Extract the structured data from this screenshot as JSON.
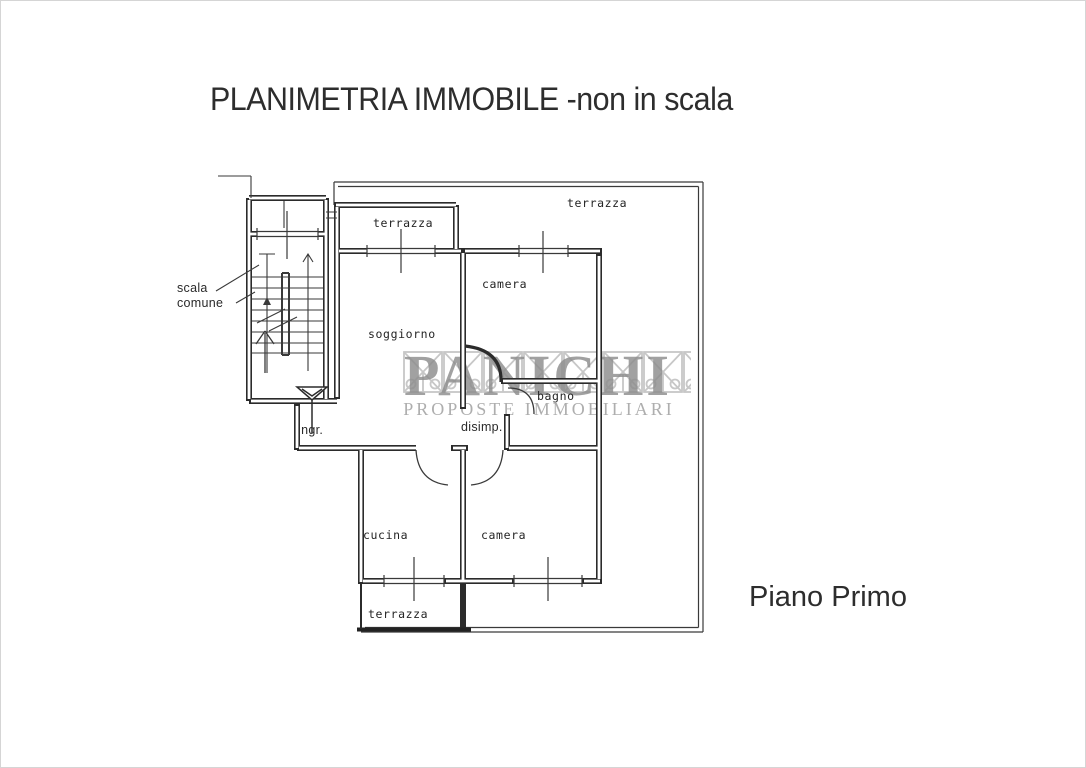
{
  "page": {
    "title": "PLANIMETRIA IMMOBILE -non in scala",
    "floor_label": "Piano Primo"
  },
  "watermark": {
    "brand": "PANICHI",
    "tagline": "PROPOSTE IMMOBILIARI"
  },
  "plan": {
    "labels": {
      "terrazza_top": "terrazza",
      "terrazza_main": "terrazza",
      "terrazza_bottom": "terrazza",
      "camera_north": "camera",
      "camera_south": "camera",
      "soggiorno": "soggiorno",
      "cucina": "cucina",
      "bagno": "bagno",
      "disimpegno": "disimp.",
      "ingresso": "ingr.",
      "scala_line1": "scala",
      "scala_line2": "comune"
    }
  },
  "colors": {
    "ink": "#2b2b2b",
    "thin_line": "#3a3a3a",
    "watermark_gray": "#8d8d8d",
    "tagline_gray": "#a6a6a6",
    "trellis_gray": "#b9b9b9",
    "paper": "#ffffff"
  }
}
